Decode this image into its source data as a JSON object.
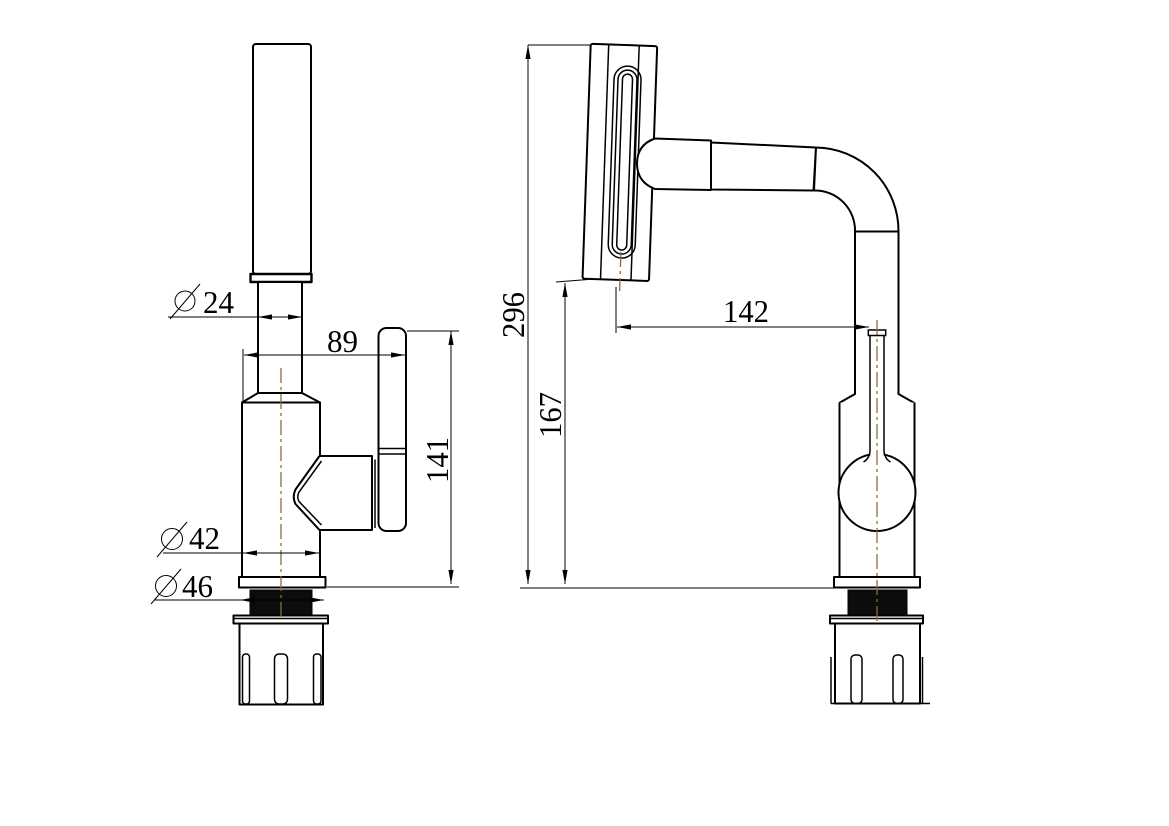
{
  "drawing": {
    "type": "technical-drawing",
    "subject": "faucet-two-view-dimensioned-drawing",
    "background_color": "#ffffff",
    "line_color": "#000000",
    "centerline_color": "#8a6d3b",
    "diameter_symbol": "⌀",
    "views": {
      "side_view": {
        "name": "side view (left figure)",
        "dimensions": [
          {
            "id": "spout-diameter",
            "value": "24",
            "diameter": true
          },
          {
            "id": "spout-reach",
            "value": "89",
            "diameter": false
          },
          {
            "id": "handle-height",
            "value": "141",
            "diameter": false
          },
          {
            "id": "body-diameter",
            "value": "42",
            "diameter": true
          },
          {
            "id": "base-thread-diameter",
            "value": "46",
            "diameter": true
          }
        ]
      },
      "front_view": {
        "name": "front view (right figure)",
        "dimensions": [
          {
            "id": "overall-height",
            "value": "296"
          },
          {
            "id": "head-to-handle-distance",
            "value": "142"
          },
          {
            "id": "base-to-head-height",
            "value": "167"
          }
        ]
      }
    }
  }
}
